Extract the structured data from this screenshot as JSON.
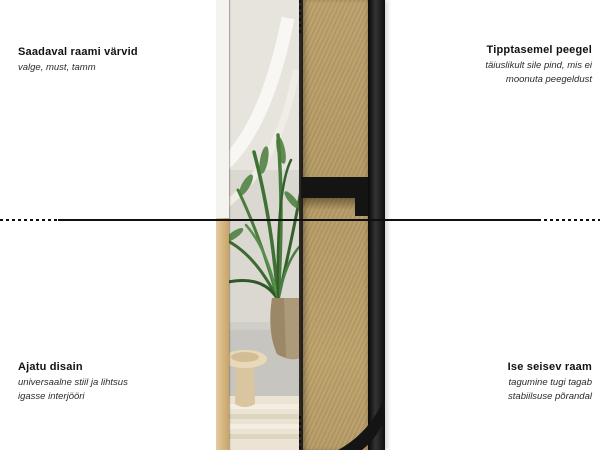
{
  "annotations": {
    "top_left": {
      "title": "Saadaval raami värvid",
      "lines": [
        "valge, must, tamm"
      ]
    },
    "top_right": {
      "title": "Tipptasemel peegel",
      "lines": [
        "täiuslikult sile pind, mis ei",
        "moonuta peegeldust"
      ]
    },
    "bottom_left": {
      "title": "Ajatu disain",
      "lines": [
        "universaalne stiil ja lihtsus",
        "igasse interjööri"
      ]
    },
    "bottom_right": {
      "title": "Ise seisev raam",
      "lines": [
        "tagumine tugi tagab",
        "stabiilsuse põrandal"
      ]
    }
  },
  "product": {
    "front_view": "floor-mirror-front-photo-in-interior",
    "back_view": "floor-mirror-back-mdf-panel-with-black-frame-and-stand"
  },
  "colors": {
    "background": "#ffffff",
    "mdf_board": "#b69b65",
    "frame_black": "#141414",
    "frame_oak": "#d4ad74",
    "divider_line": "#101010",
    "plant_green": "#4a7c3c"
  }
}
